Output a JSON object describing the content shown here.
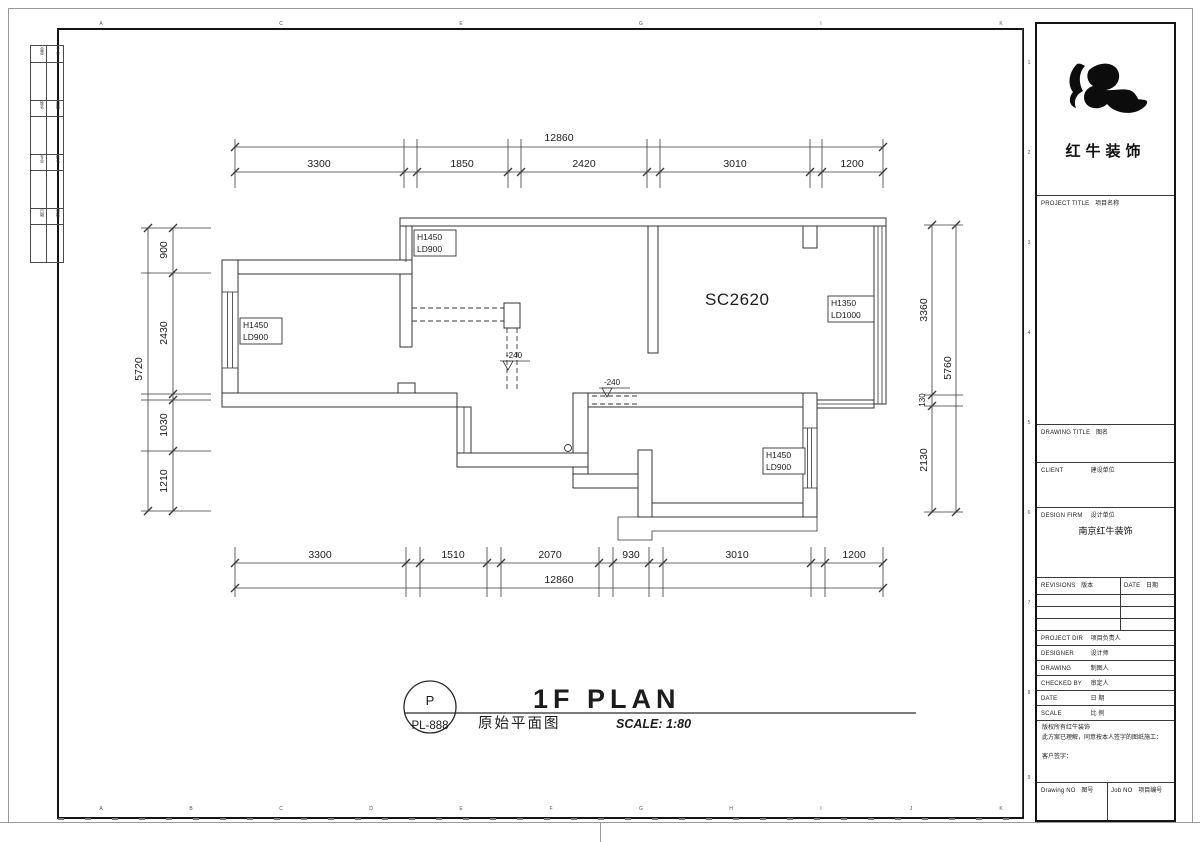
{
  "sheet": {
    "grid_letters": [
      "A",
      "B",
      "C",
      "D",
      "E",
      "F",
      "G",
      "H",
      "I",
      "J",
      "K"
    ],
    "grid_numbers": [
      "1",
      "2",
      "3",
      "4",
      "5",
      "6",
      "7",
      "8",
      "9"
    ],
    "sign_strip": {
      "rows": [
        [
          "会签",
          "专业"
        ],
        [
          "姓名",
          "日期"
        ],
        [
          "专业",
          "姓名"
        ],
        [
          "日期",
          "审核"
        ]
      ]
    }
  },
  "plan": {
    "room_code": "SC2620",
    "window_labels": [
      {
        "h": "H1450",
        "ld": "LD900"
      },
      {
        "h": "H1450",
        "ld": "LD900"
      },
      {
        "h": "H1350",
        "ld": "LD1000"
      },
      {
        "h": "H1450",
        "ld": "LD900"
      }
    ],
    "level_markers": [
      "-240",
      "-240"
    ]
  },
  "dims": {
    "top": {
      "total": "12860",
      "segments": [
        "3300",
        "1850",
        "2420",
        "3010",
        "1200"
      ]
    },
    "bottom": {
      "total": "12860",
      "segments": [
        "3300",
        "1510",
        "2070",
        "930",
        "3010",
        "1200"
      ]
    },
    "left": {
      "total": "5720",
      "segments": [
        "900",
        "2430",
        "1030",
        "1210"
      ]
    },
    "right": {
      "total": "5760",
      "segments": [
        "3360",
        "130",
        "2130"
      ]
    }
  },
  "titlebar": {
    "stamp_letter": "P",
    "stamp_code": "PL-888",
    "plan_title": "1F PLAN",
    "cn_title": "原始平面图",
    "scale_label": "SCALE: 1:80"
  },
  "title_block": {
    "logo_text": "红牛装饰",
    "project_title_en": "PROJECT TITLE",
    "project_title_cn": "项目名称",
    "drawing_title_en": "DRAWING TITLE",
    "drawing_title_cn": "图名",
    "client_en": "CLIENT",
    "client_cn": "建设单位",
    "design_firm_en": "DESIGN FIRM",
    "design_firm_cn": "设计单位",
    "design_firm_value": "南京红牛装饰",
    "revisions_en": "REVISIONS",
    "revisions_cn": "版本",
    "rev_date_en": "DATE",
    "rev_date_cn": "日期",
    "rows": [
      {
        "en": "PROJECT DIR",
        "cn": "项目负责人"
      },
      {
        "en": "DESIGNER",
        "cn": "设计师"
      },
      {
        "en": "DRAWING",
        "cn": "制图人"
      },
      {
        "en": "CHECKED BY",
        "cn": "审定人"
      },
      {
        "en": "DATE",
        "cn": "日 期"
      },
      {
        "en": "SCALE",
        "cn": "比 例"
      }
    ],
    "copyright_line1": "版权所有红牛装饰",
    "copyright_line2": "此方案已理解，同意按本人签字的图纸施工：",
    "copyright_line3": "客户签字：",
    "drawing_no_en": "Drawing NO",
    "drawing_no_cn": "图号",
    "job_no_en": "Job NO",
    "job_no_cn": "项目编号"
  }
}
